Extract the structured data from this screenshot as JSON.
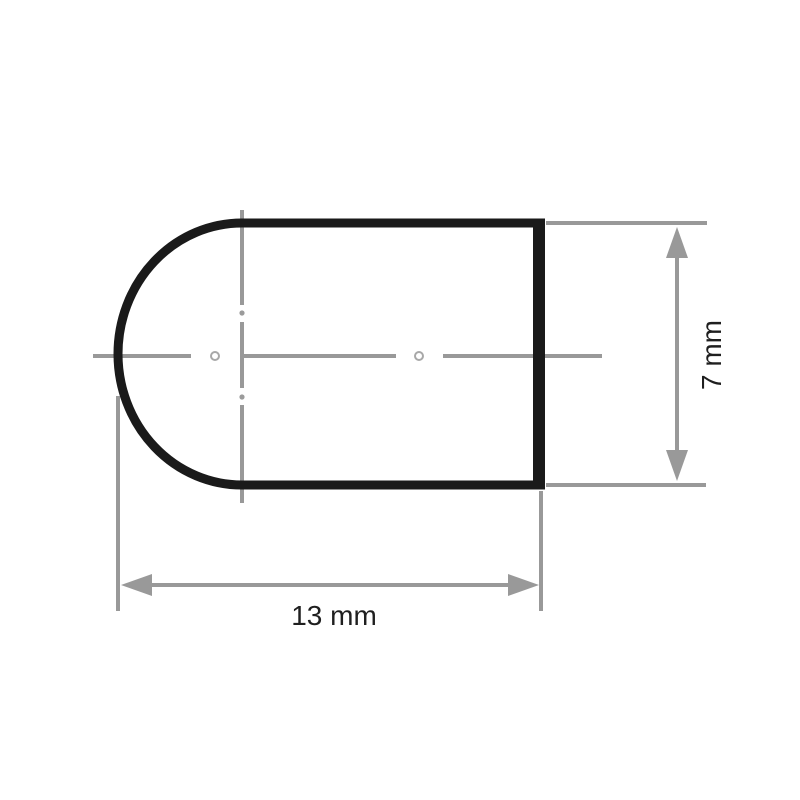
{
  "drawing": {
    "dimensions": {
      "width": {
        "label": "13 mm",
        "value": 13,
        "unit": "mm"
      },
      "height": {
        "label": "7 mm",
        "value": 7,
        "unit": "mm"
      }
    },
    "colors": {
      "outline": "#1a1a1a",
      "dimension": "#999999",
      "text": "#1f1f1f",
      "background": "#ffffff"
    }
  }
}
